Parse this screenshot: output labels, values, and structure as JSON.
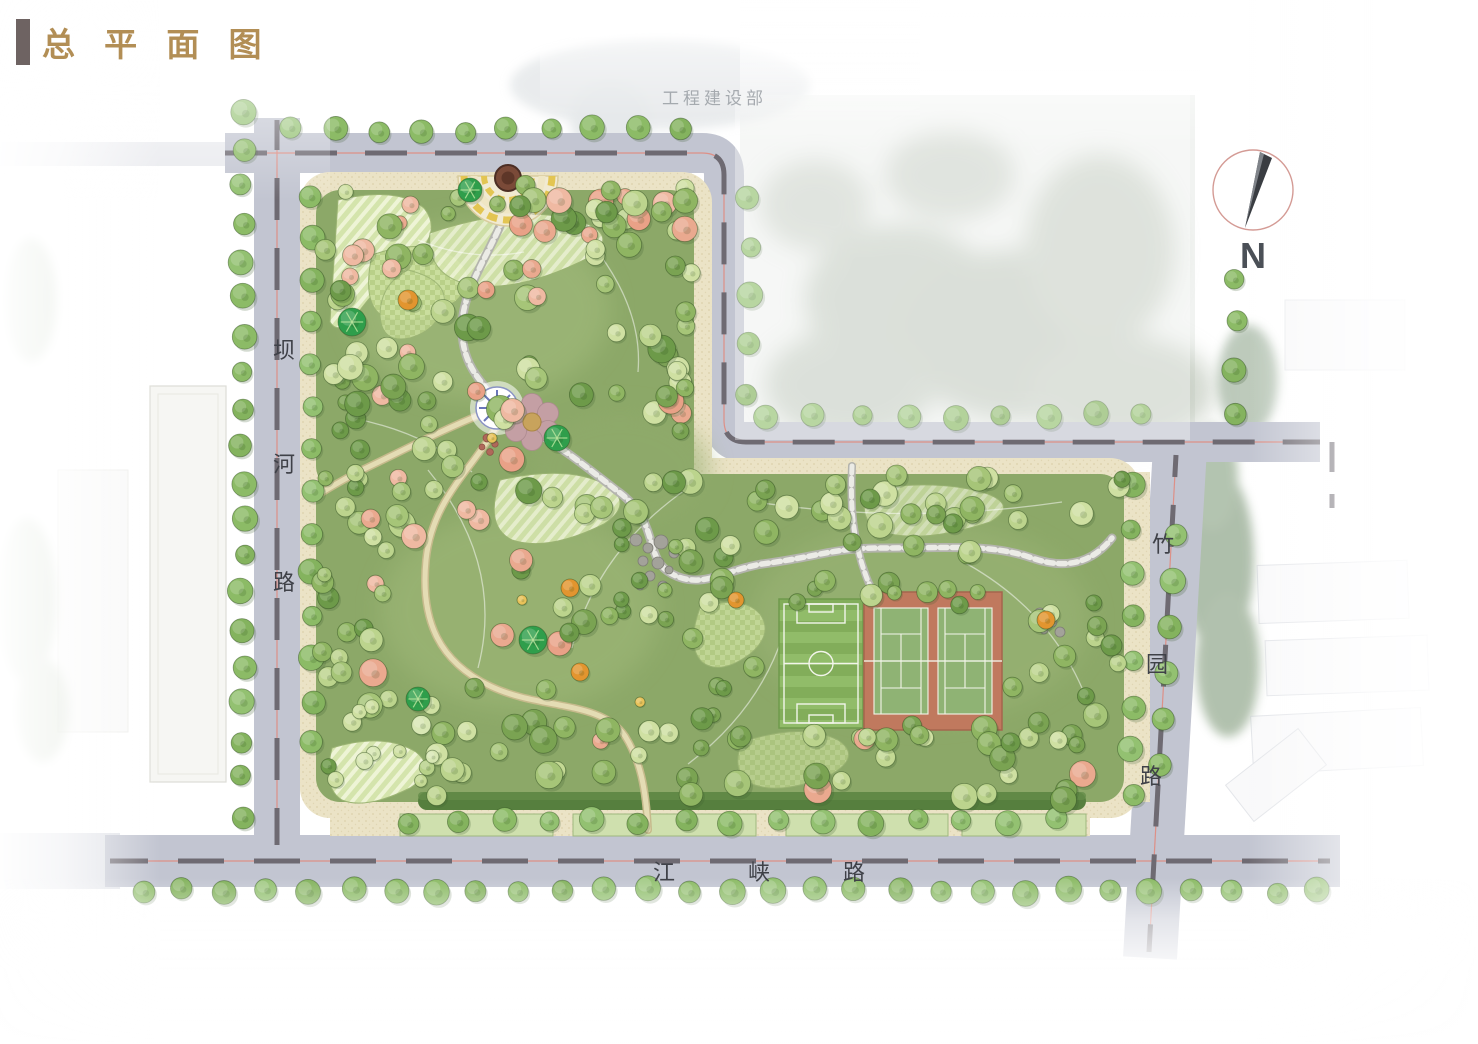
{
  "header": {
    "title": "总 平 面 图"
  },
  "overlay": {
    "top_building_label": "工程建设部"
  },
  "compass": {
    "label": "N"
  },
  "roads": {
    "west": {
      "name": "坝河路",
      "chars": [
        "坝",
        "河",
        "路"
      ]
    },
    "east": {
      "name": "竹园路",
      "chars": [
        "竹",
        "园",
        "路"
      ]
    },
    "south": {
      "name": "江峡路",
      "chars": [
        "江",
        "峡",
        "路"
      ]
    }
  },
  "colors": {
    "title_accent": "#b28e55",
    "road": "#c2c5d1",
    "road_dash": "#6e6a72",
    "road_centerline_red": "#e08a7e",
    "sidewalk": "#ebe3c6",
    "park_green": "#8ca868",
    "soccer_green": "#86b25f",
    "tennis_terracotta": "#c0795e",
    "tennis_court_green": "#8fb374"
  }
}
